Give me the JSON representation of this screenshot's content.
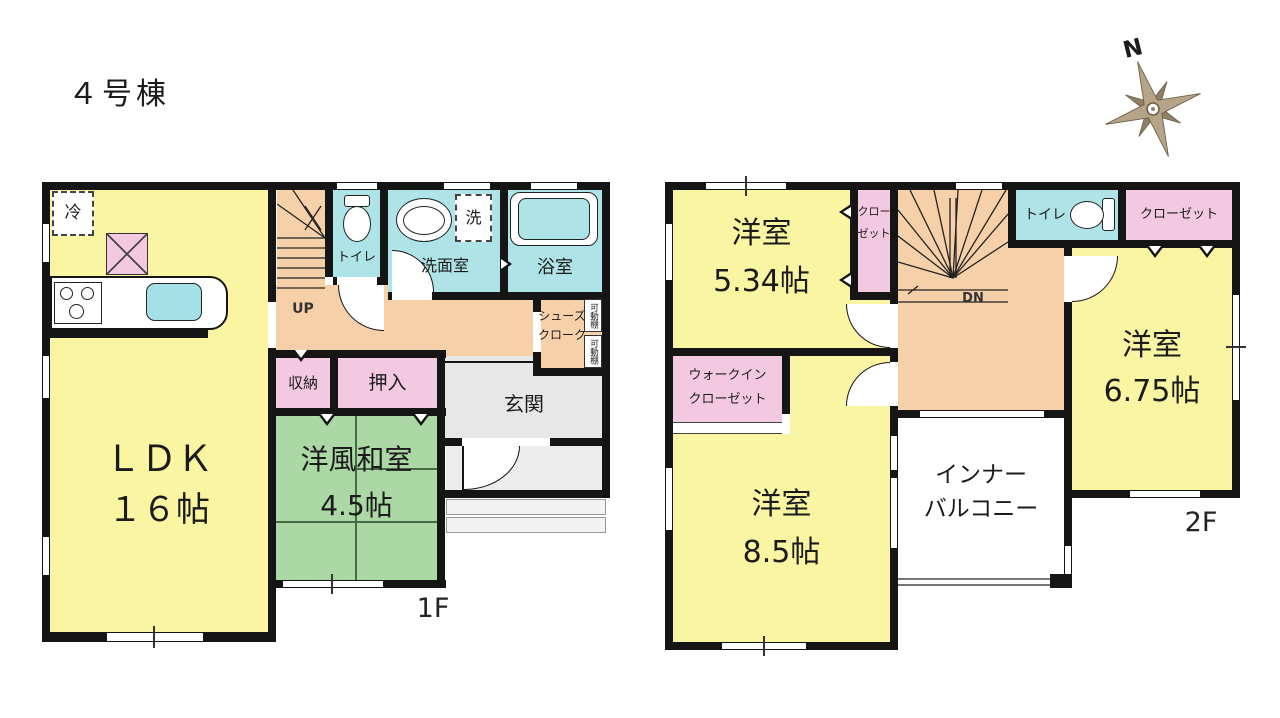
{
  "title": "４号棟",
  "compass": {
    "north": "N"
  },
  "colors": {
    "wall": "#151515",
    "yellow": "#f9f5a2",
    "green": "#abd8a4",
    "pink": "#f3c9e2",
    "cyan": "#aee4e8",
    "peach": "#f6d0a8",
    "gray": "#e7e7e8",
    "tan": "#b5a487"
  },
  "floor1": {
    "label": "1F",
    "ldk": {
      "name": "ＬＤＫ",
      "size": "１６帖"
    },
    "washitsu": {
      "name": "洋風和室",
      "size": "4.5帖"
    },
    "storage": "収納",
    "oshiire": "押入",
    "genkan": "玄関",
    "toilet": "トイレ",
    "washroom": "洗面室",
    "bathroom": "浴室",
    "laundry": "洗",
    "fridge": "冷",
    "stairs_up": "UP",
    "shoes_cloak": {
      "line1": "シューズ",
      "line2": "クローク"
    },
    "movable_shelf": "可動棚"
  },
  "floor2": {
    "label": "2F",
    "room_534": {
      "name": "洋室",
      "size": "5.34帖"
    },
    "room_675": {
      "name": "洋室",
      "size": "6.75帖"
    },
    "room_85": {
      "name": "洋室",
      "size": "8.5帖"
    },
    "wic": {
      "line1": "ウォークイン",
      "line2": "クローゼット"
    },
    "closet_side": {
      "line1": "クロー",
      "line2": "ゼット"
    },
    "closet_top": "クローゼット",
    "toilet": "トイレ",
    "stairs_down": "DN",
    "balcony": {
      "line1": "インナー",
      "line2": "バルコニー"
    }
  }
}
